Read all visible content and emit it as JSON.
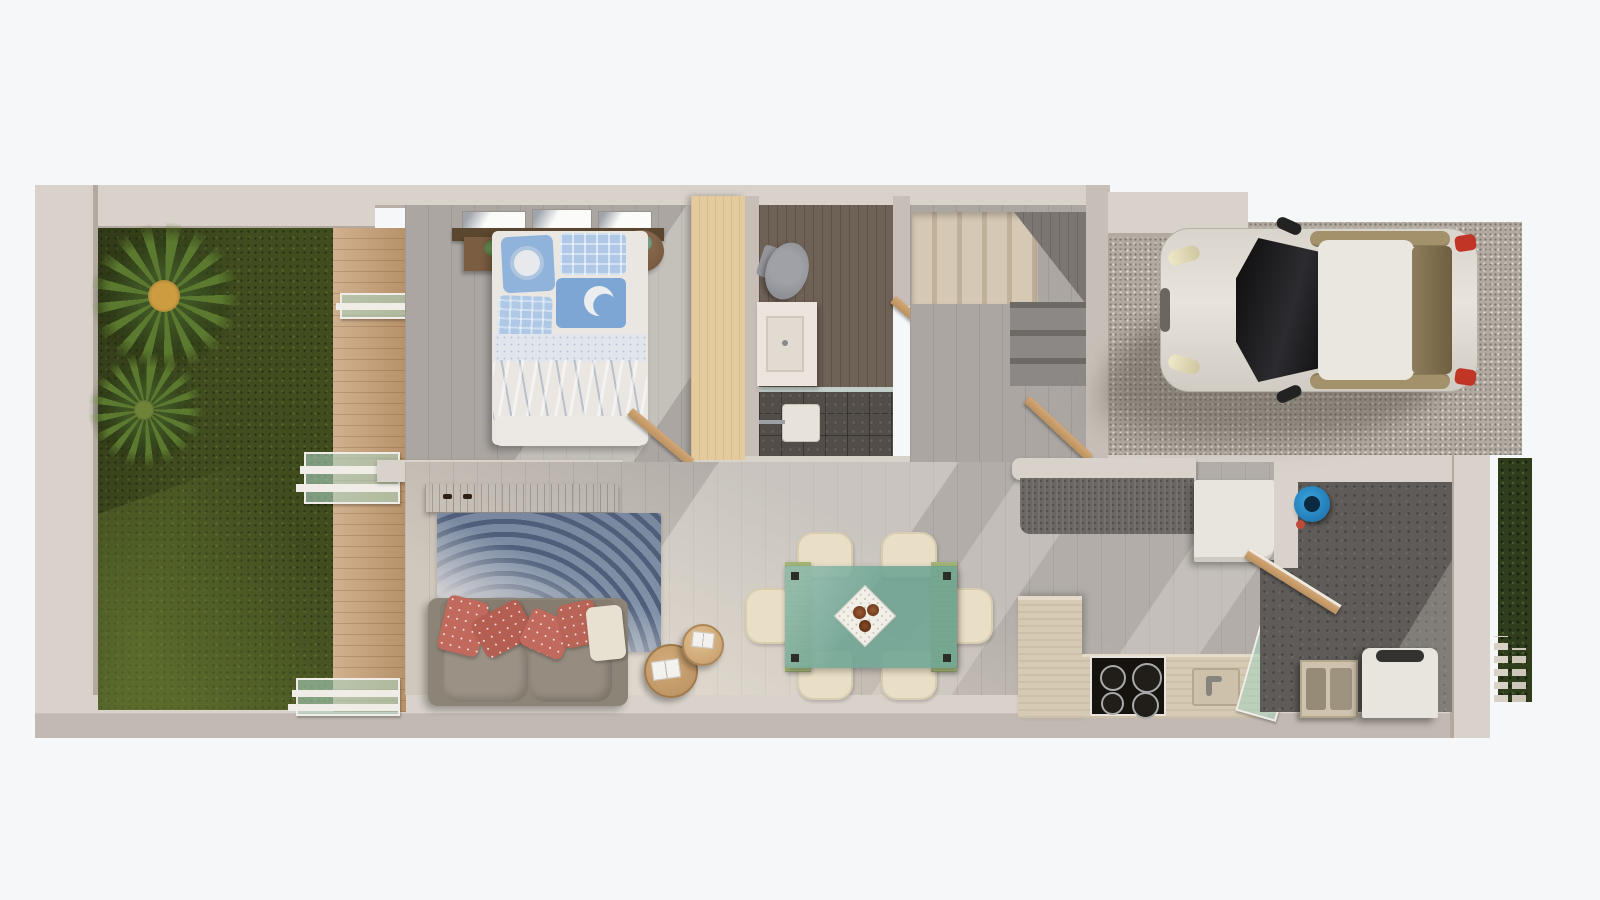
{
  "scene": {
    "type": "3d-floor-plan-render",
    "view": "top-down",
    "rooms": [
      "garden",
      "wood-deck",
      "bedroom",
      "bathroom",
      "staircase",
      "hallway",
      "garage-driveway",
      "living-room",
      "dining-area",
      "kitchen",
      "service-patio"
    ],
    "objects": [
      "palm-plant",
      "palm-plant-small",
      "sliding-glass-door",
      "double-bed",
      "sun-pillow",
      "moon-pillow",
      "nightstand",
      "round-side-table",
      "wall-pictures",
      "wardrobe",
      "toilet",
      "vanity-sink",
      "shower",
      "white-car",
      "staircase-upper-flight",
      "staircase-lower-flight",
      "tv-console",
      "fingerprint-rug",
      "gray-sofa",
      "coral-pillows",
      "round-coffee-tables",
      "open-books",
      "dining-table-glass",
      "dining-chairs",
      "placemat-with-bowls",
      "kitchen-peninsula",
      "fridge",
      "tall-cabinet",
      "cooktop",
      "kitchen-sink",
      "blue-bucket",
      "laundry-sink",
      "washing-machine",
      "hedge",
      "slat-fence",
      "interior-doors"
    ]
  },
  "palette": {
    "background": "#f6f7f9",
    "wall_top": "#d9d2cb",
    "wall_face": "#c7bfb7",
    "wall_shadow": "#a79d94",
    "grass_dark": "#3c481d",
    "deck_wood": "#c6a076",
    "floor_gray_wood": "#aba6a2",
    "floor_travertine": "#d9d1c5",
    "bath_floor": "#6e6156",
    "shower_tile": "#524d49",
    "stair_beige": "#d5c8b4",
    "stair_gray": "#8c8885",
    "gravel": "#b2aaa0",
    "car_body": "#dcd8d0",
    "car_glass": "#1a1a1a",
    "car_window_tint": "#a3916c",
    "taillight_red": "#c13526",
    "rug_blue": "#8495ac",
    "rug_line": "#4e5e7b",
    "sofa_gray": "#8d8478",
    "pillow_coral": "#c0695c",
    "pillow_cream": "#e8e1d2",
    "table_glass_green": "#74a898",
    "runner_olive": "#a4b578",
    "chair_cream": "#e9dfc7",
    "counter_stone": "#6b6764",
    "kitchen_travertine": "#d7cab4",
    "cooktop_black": "#16130f",
    "appliance_white": "#e8e4de",
    "patio_concrete": "#5e5b58",
    "bucket_blue": "#1a80c2",
    "hedge_green": "#2f3d1d",
    "door_wood": "#c89d6d",
    "console_wood": "#7a5c3c",
    "bed_blue": "#8fb3da",
    "bed_blue_light": "#aec8e6",
    "bed_white": "#eae7e2"
  }
}
